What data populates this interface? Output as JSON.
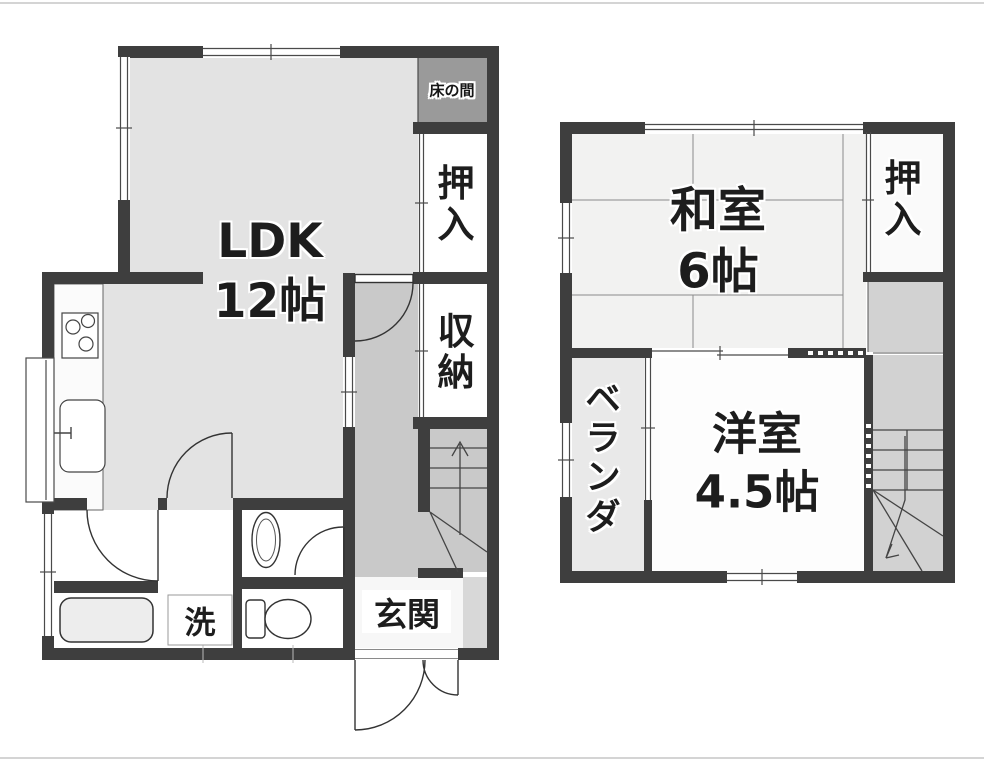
{
  "floor1": {
    "rooms": {
      "ldk": {
        "line1": "LDK",
        "line2": "12帖"
      },
      "tokonoma": {
        "label": "床の間"
      },
      "oshiire": {
        "chars": [
          "押",
          "入"
        ]
      },
      "storage": {
        "chars": [
          "収",
          "納"
        ]
      },
      "genkan": {
        "label": "玄関"
      },
      "laundry": {
        "label": "洗"
      }
    }
  },
  "floor2": {
    "rooms": {
      "washitsu": {
        "line1": "和室",
        "line2": "6帖"
      },
      "oshiire": {
        "chars": [
          "押",
          "入"
        ]
      },
      "youshitsu": {
        "line1": "洋室",
        "line2": "4.5帖"
      },
      "veranda": {
        "chars": [
          "ベ",
          "ラ",
          "ン",
          "ダ"
        ]
      }
    }
  },
  "colors": {
    "wall": "#3e3e3e",
    "ldk_floor": "#e3e3e3",
    "corridor": "#c9c9c9",
    "tokonoma": "#9a9a9a",
    "landing": "#d2d2d2",
    "veranda": "#e9e9e9",
    "washitsu_floor": "#f2f2f1",
    "background": "#ffffff"
  }
}
